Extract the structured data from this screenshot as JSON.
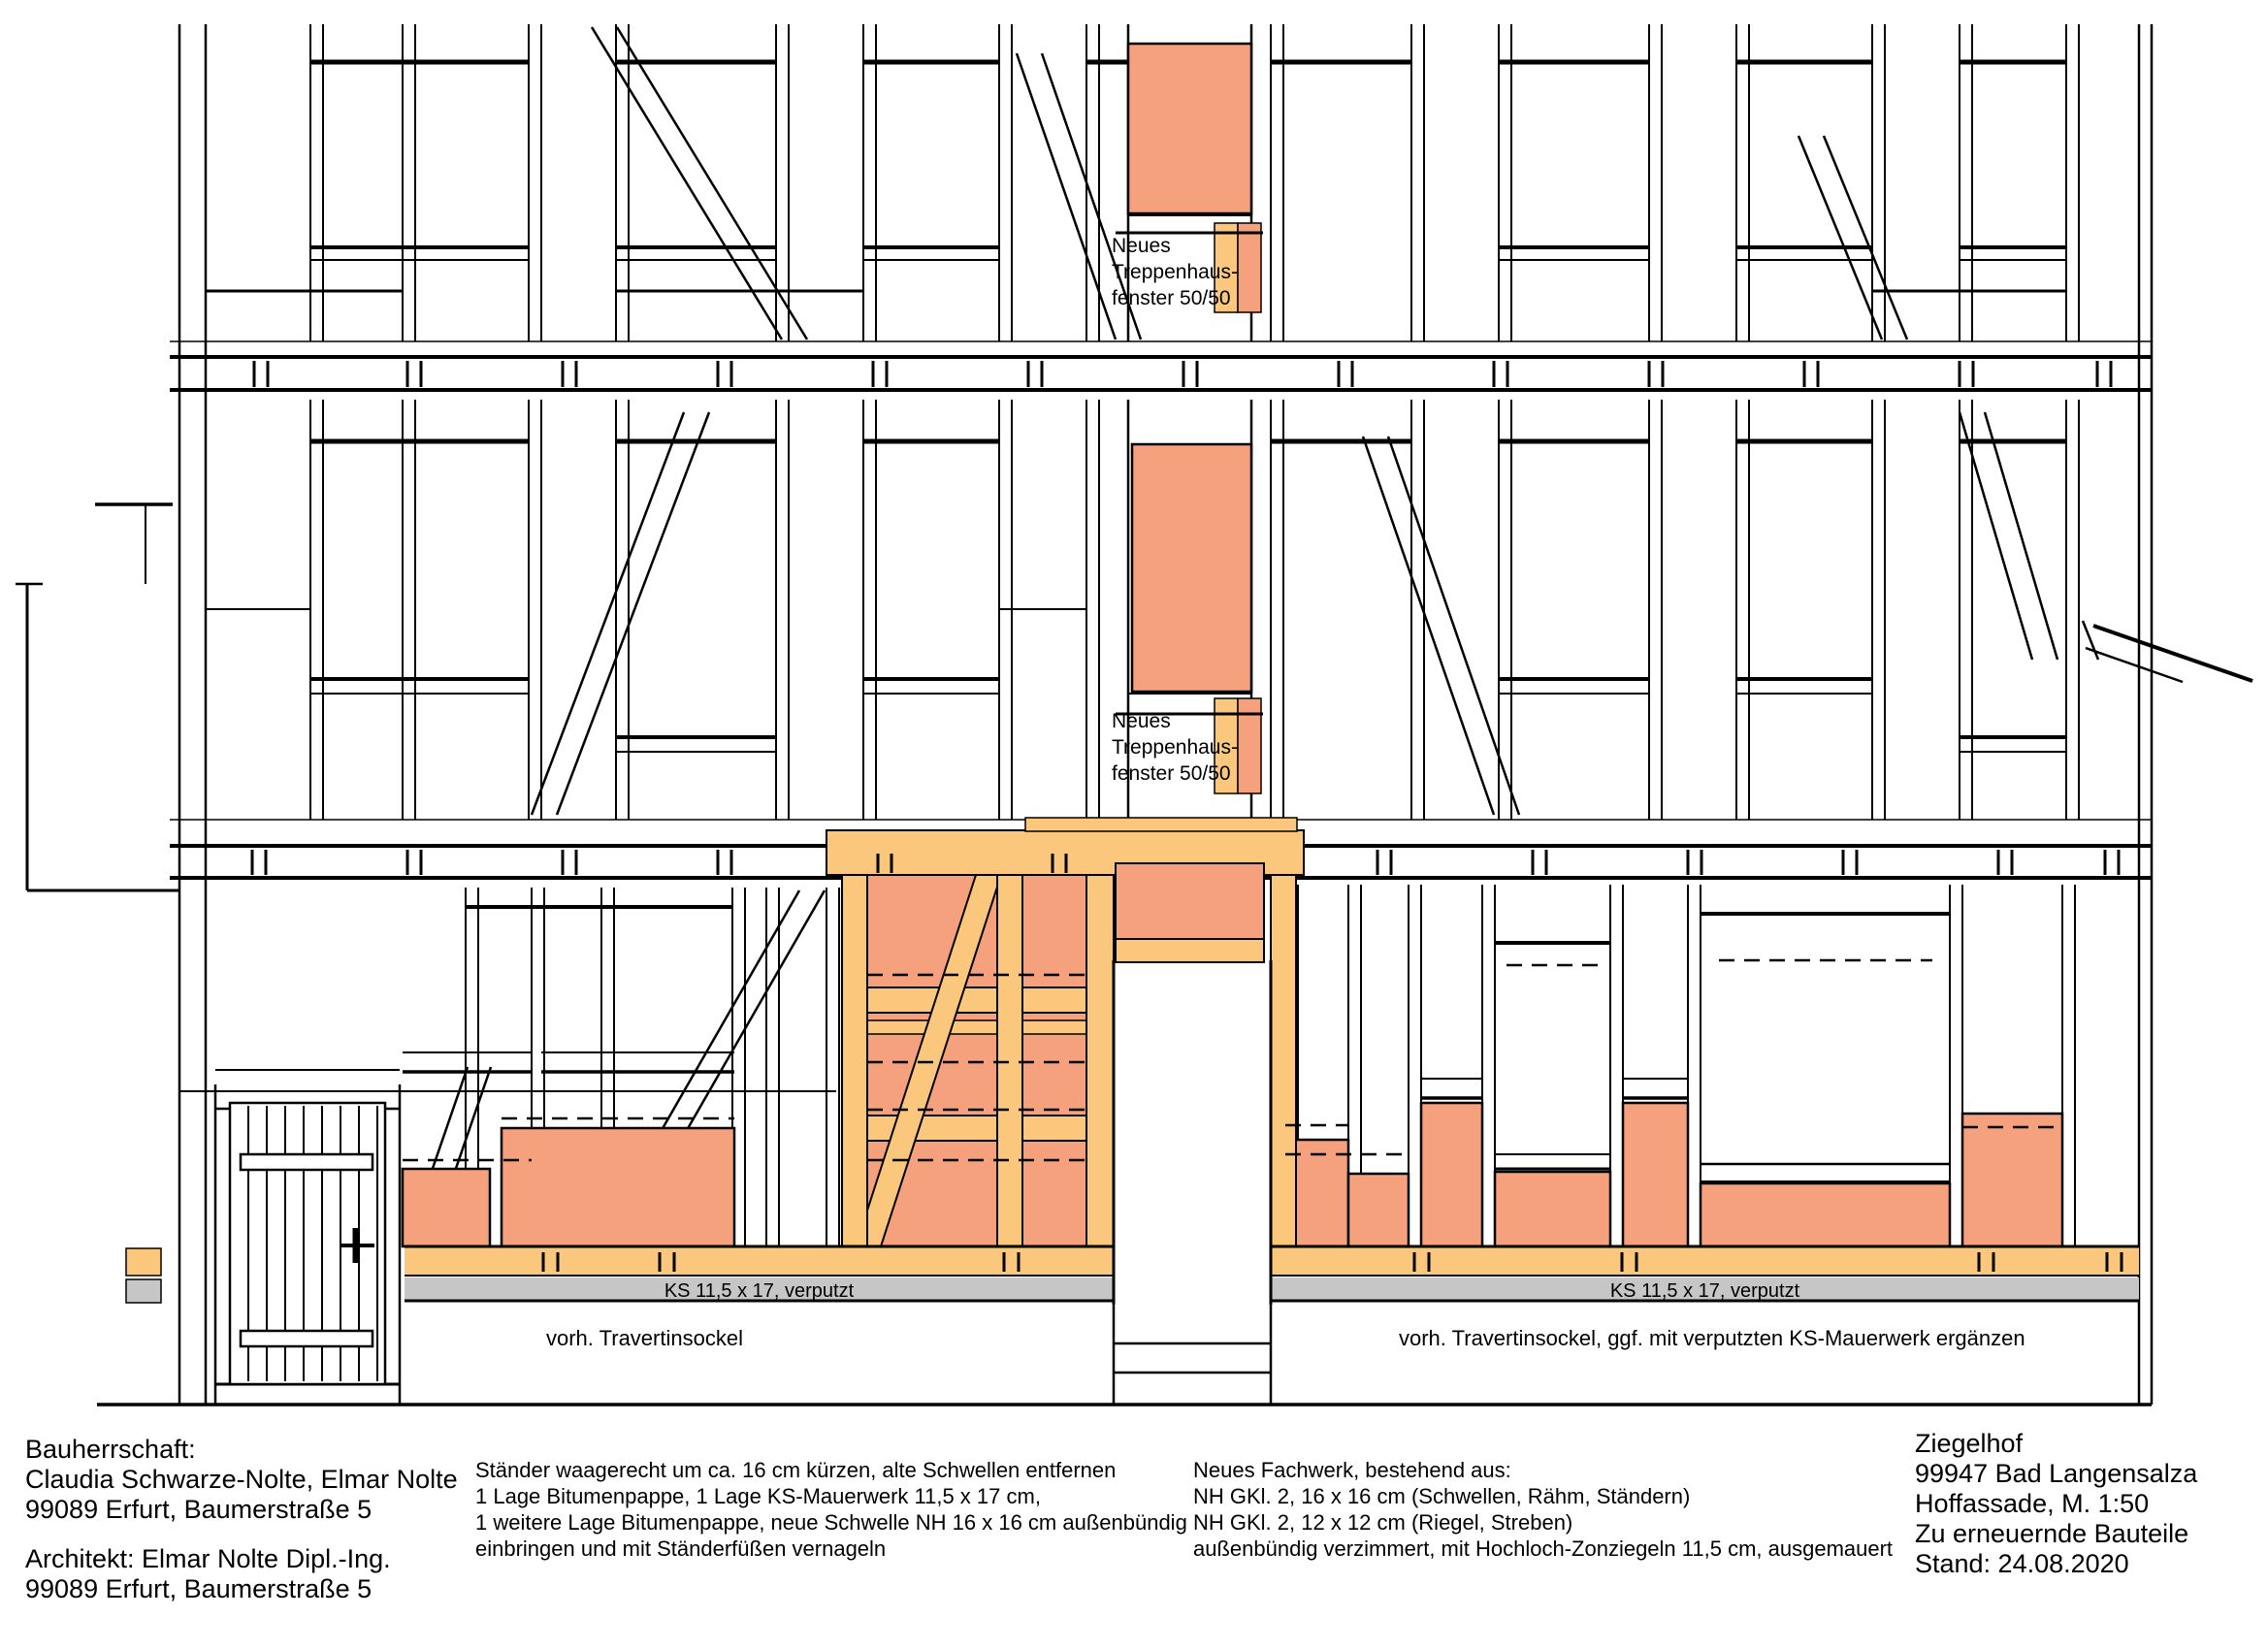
{
  "colors": {
    "salmon": "#F5A17D",
    "timber": "#FBC77D",
    "sockel_gray": "#C6C6C6",
    "line": "#000000",
    "background": "#FFFFFF"
  },
  "drawing": {
    "stair_window_label_upper": {
      "lines": [
        "Neues",
        "Treppenhaus-",
        "fenster 50/50"
      ]
    },
    "stair_window_label_lower": {
      "lines": [
        "Neues",
        "Treppenhaus-",
        "fenster 50/50"
      ]
    },
    "ks_band_label_left": "KS 11,5 x 17, verputzt",
    "ks_band_label_right": "KS 11,5 x 17, verputzt",
    "sockel_label_left": "vorh. Travertinsockel",
    "sockel_label_right": "vorh. Travertinsockel, ggf. mit verputzten KS-Mauerwerk ergänzen"
  },
  "title_block": {
    "client": {
      "lines": [
        "Bauherrschaft:",
        "Claudia Schwarze-Nolte, Elmar Nolte",
        "99089 Erfurt, Baumerstraße 5"
      ]
    },
    "architect": {
      "lines": [
        "Architekt: Elmar Nolte Dipl.-Ing.",
        "99089 Erfurt, Baumerstraße 5"
      ]
    },
    "note_sill": {
      "lines": [
        "Ständer waagerecht um ca. 16 cm kürzen, alte Schwellen entfernen",
        "1 Lage Bitumenpappe, 1 Lage KS-Mauerwerk 11,5 x 17 cm,",
        "1 weitere Lage Bitumenpappe, neue Schwelle NH 16 x 16 cm außenbündig",
        "einbringen und mit Ständerfüßen vernageln"
      ]
    },
    "note_framework": {
      "lines": [
        "Neues Fachwerk, bestehend aus:",
        "NH GKl. 2, 16 x 16 cm (Schwellen, Rähm, Ständern)",
        "NH GKl. 2, 12 x 12 cm (Riegel, Streben)",
        "außenbündig verzimmert, mit Hochloch-Zonziegeln 11,5 cm, ausgemauert"
      ]
    },
    "project": {
      "lines": [
        "Ziegelhof",
        "99947 Bad Langensalza",
        "Hoffassade, M. 1:50",
        "Zu erneuernde Bauteile",
        "Stand: 24.08.2020"
      ]
    }
  }
}
